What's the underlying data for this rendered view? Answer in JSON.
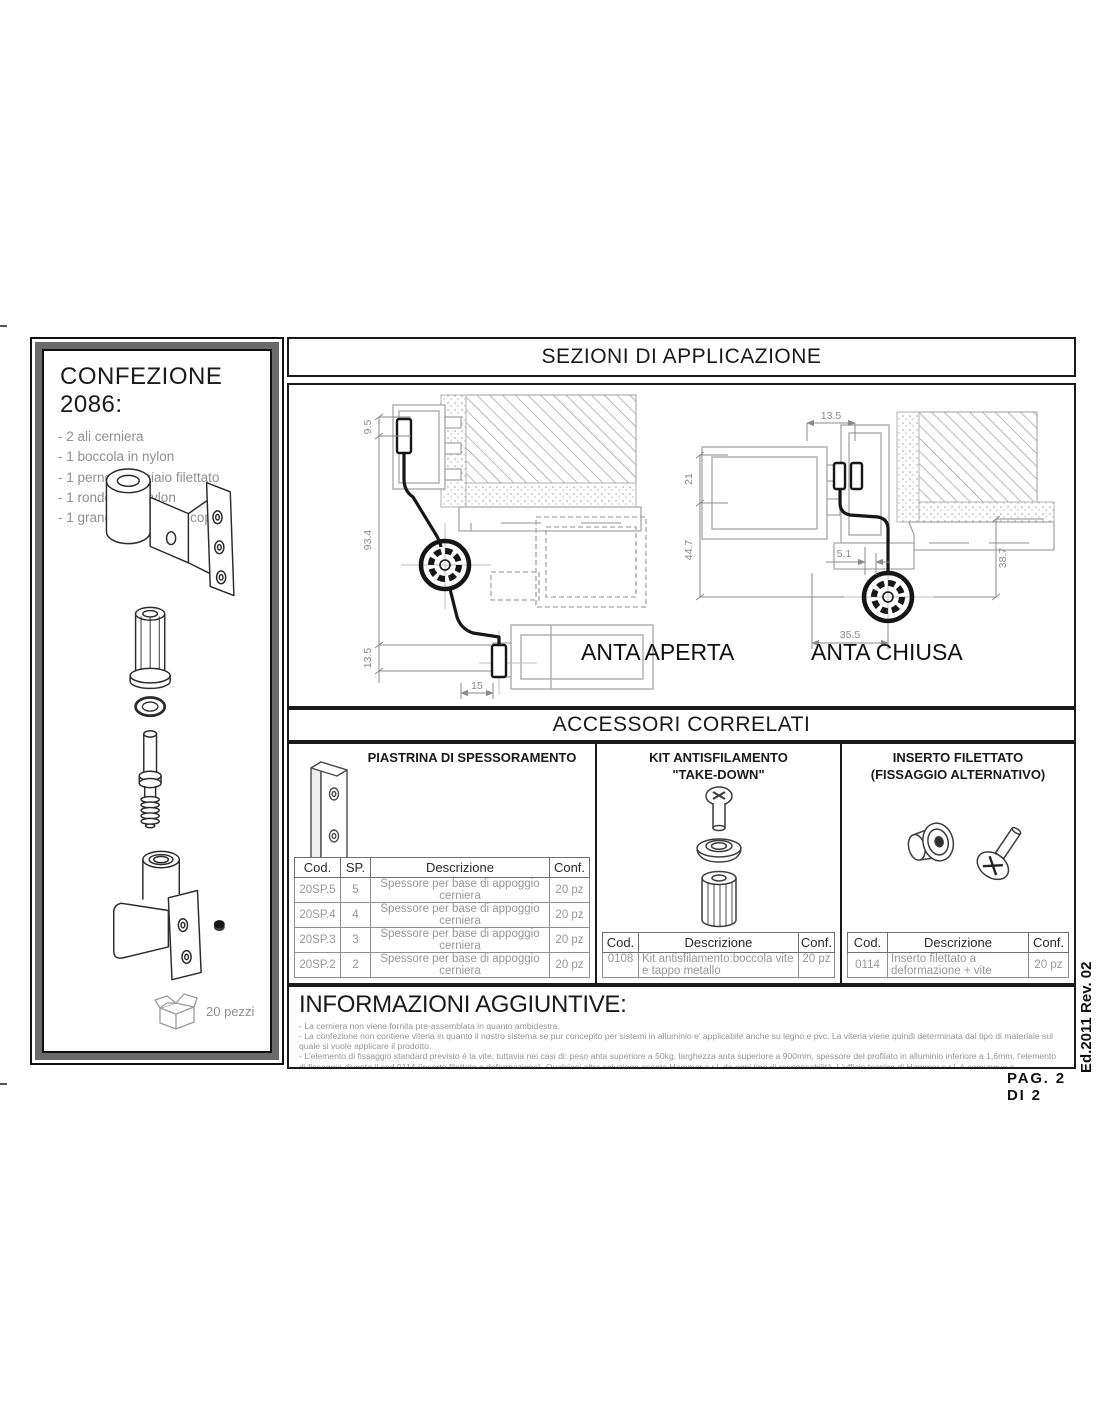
{
  "colors": {
    "line_gray": "#a6a6a6",
    "text_gray": "#8f8f8f",
    "panel_border_gray": "#6a6a6a",
    "ink": "#1a1a1a"
  },
  "confezione": {
    "title": "CONFEZIONE 2086:",
    "items": [
      "- 2 ali cerniera",
      "- 1 boccola in nylon",
      "- 1 perno in acciaio filettato",
      "- 1 rondella in nylon",
      "- 1 grano M5x6 punta coppa"
    ],
    "quantity_label": "20 pezzi"
  },
  "sezioni": {
    "title": "SEZIONI DI APPLICAZIONE",
    "aperta": {
      "label": "ANTA APERTA",
      "dims": {
        "v1": "9.5",
        "v2": "93.4",
        "v3": "13.5",
        "h1": "15"
      }
    },
    "chiusa": {
      "label": "ANTA CHIUSA",
      "dims": {
        "h1": "13.5",
        "v1": "21",
        "v2": "44.7",
        "h2": "5.1",
        "v3": "38.7",
        "h3": "35.5"
      }
    }
  },
  "accessori": {
    "title": "ACCESSORI CORRELATI",
    "panels": [
      {
        "title": "PIASTRINA DI SPESSORAMENTO",
        "table": {
          "headers": [
            "Cod.",
            "SP.",
            "Descrizione",
            "Conf."
          ],
          "rows": [
            [
              "20SP.5",
              "5",
              "Spessore per base di appoggio cerniera",
              "20 pz"
            ],
            [
              "20SP.4",
              "4",
              "Spessore per base di appoggio cerniera",
              "20 pz"
            ],
            [
              "20SP.3",
              "3",
              "Spessore per base di appoggio cerniera",
              "20 pz"
            ],
            [
              "20SP.2",
              "2",
              "Spessore per base di appoggio cerniera",
              "20 pz"
            ]
          ]
        }
      },
      {
        "title": "KIT ANTISFILAMENTO",
        "subtitle": "\"TAKE-DOWN\"",
        "table": {
          "headers": [
            "Cod.",
            "Descrizione",
            "Conf."
          ],
          "rows": [
            [
              "0108",
              "Kit antisfilamento:boccola vite e tappo metallo",
              "20 pz"
            ]
          ]
        }
      },
      {
        "title": "INSERTO FILETTATO",
        "subtitle": "(FISSAGGIO ALTERNATIVO)",
        "table": {
          "headers": [
            "Cod.",
            "Descrizione",
            "Conf."
          ],
          "rows": [
            [
              "0114",
              "Inserto filettato a deformazione + vite",
              "20 pz"
            ]
          ]
        }
      }
    ]
  },
  "informazioni": {
    "title": "INFORMAZIONI AGGIUNTIVE:",
    "bullets": [
      "- La cerniera non viene fornita pre-assemblata in quanto ambidestra.",
      "- La confezione non contiene viteria in quanto il nostro sistema se pur concepito per sistemi in alluminio e' applicabile anche su legno e pvc. La viteria viene quindi determinata dal tipo di materiale sul quale si vuole applicare il prodotto.",
      "- L'elemento di fissaggio standard previsto è la vite, tuttavia nei casi di: peso anta superiore a 50kg, larghezza anta superiore a 900mm, spessore del profilato in alluminio inferiore a 1,6mm, l'elemento di fissaggio diventa il cod.0114 (inserto filettato a deformazione). Qualsiasi altra soluzione esenta Hammer s.r.l. da ogni tipo di responsabilità. L'ufficio tecnico di Hammer s.r.l. è comunque a disposizione per valutare soluzioni di fissaggio alternative."
    ]
  },
  "footer": {
    "edition": "Ed.2011 Rev. 02",
    "page_number": "PAG. 2 DI 2"
  }
}
